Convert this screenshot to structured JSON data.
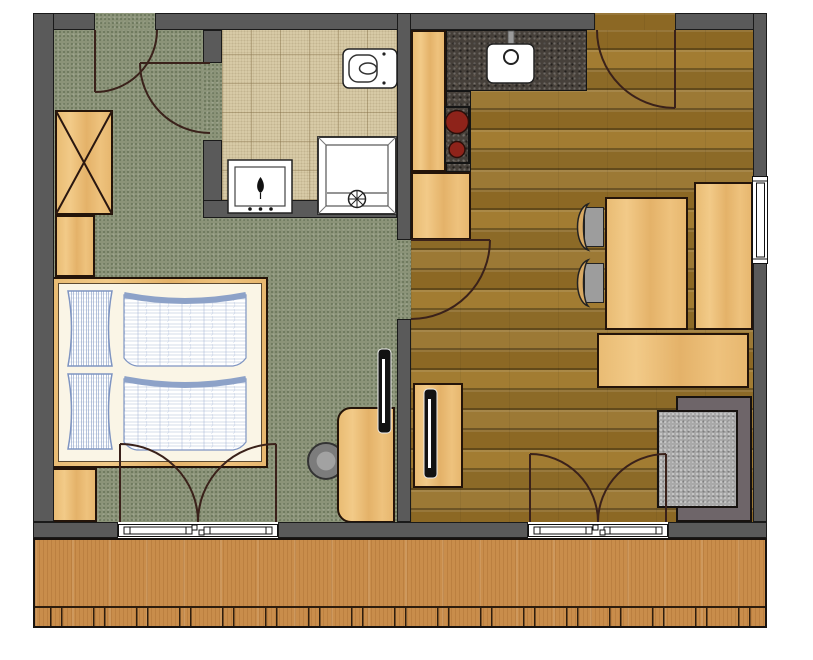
{
  "colors": {
    "background": "#ffffff",
    "wall": "#5a5a5a",
    "wall_outline": "#1a1a1a",
    "carpet_green": "#8b9378",
    "tile_beige": "#d9cca9",
    "wood_floor": "#97722a",
    "balcony_wood": "#c98d4b",
    "furniture_wood": "#ecc27d",
    "granite_counter": "#46403a",
    "burner_red": "#8e231a",
    "sofa_back_gray": "#6e6569",
    "sofa_seat_gray": "#a9a9a9",
    "chair_seat_gray": "#9d9d9d",
    "bed_sheet_cream": "#faf5e6",
    "bedding_blue": "#8da2c8",
    "door_swing": "#3a211a",
    "fixture_white": "#ffffff",
    "tv_black": "#121212"
  },
  "rooms": [
    {
      "id": "bedroom",
      "floor": "green-carpet"
    },
    {
      "id": "bathroom",
      "floor": "beige-tile"
    },
    {
      "id": "kitchen-living-room",
      "floor": "wood-parquet"
    },
    {
      "id": "balcony",
      "floor": "wood-decking-with-railing"
    }
  ],
  "fixtures": {
    "bathroom": [
      "toilet",
      "washbasin-vanity",
      "shower-with-drain"
    ],
    "kitchen": [
      "sink-with-faucet",
      "stove-two-burners",
      "granite-counter",
      "wood-cabinets"
    ]
  },
  "furniture": {
    "bedroom": [
      "wardrobe-x",
      "cabinet",
      "nightstand",
      "double-bed-two-pillows-two-duvets",
      "desk",
      "round-stool",
      "wall-mounted-tv"
    ],
    "living-area": [
      "dining-table",
      "chair",
      "chair",
      "corner-bench",
      "sideboard-bench",
      "sofa",
      "tv-sideboard",
      "tv"
    ]
  },
  "openings": {
    "doors": [
      "bedroom-entrance-door",
      "bathroom-door",
      "living-room-entrance-door",
      "bedroom-to-living-door",
      "bedroom-balcony-french-door",
      "living-balcony-french-door"
    ],
    "windows": [
      "east-wall-window"
    ]
  }
}
